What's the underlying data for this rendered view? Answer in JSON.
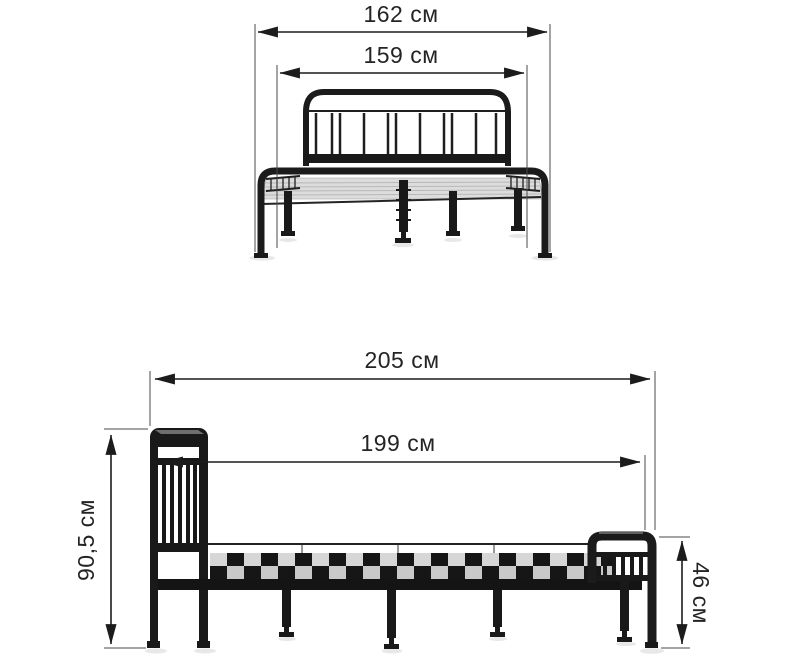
{
  "colors": {
    "background": "#ffffff",
    "dimension_ink": "#1c1c1c",
    "bed_dark": "#191919",
    "bed_highlight": "#6e6e6e",
    "deck_light": "#dcdcdc",
    "slat_light": "#d6d6d6",
    "shadow": "#e4e4e4"
  },
  "front_view": {
    "dimensions": {
      "overall_width": {
        "label": "162 см",
        "value": "162",
        "unit": "см",
        "orientation": "horizontal"
      },
      "mattress_width": {
        "label": "159 см",
        "value": "159",
        "unit": "см",
        "orientation": "horizontal"
      }
    }
  },
  "side_view": {
    "dimensions": {
      "overall_length": {
        "label": "205 см",
        "value": "205",
        "unit": "см",
        "orientation": "horizontal"
      },
      "mattress_length": {
        "label": "199 см",
        "value": "199",
        "unit": "см",
        "orientation": "horizontal"
      },
      "headboard_height": {
        "label": "90,5 см",
        "value": "90,5",
        "unit": "см",
        "orientation": "vertical"
      },
      "footboard_height": {
        "label": "46 см",
        "value": "46",
        "unit": "см",
        "orientation": "vertical"
      }
    }
  }
}
